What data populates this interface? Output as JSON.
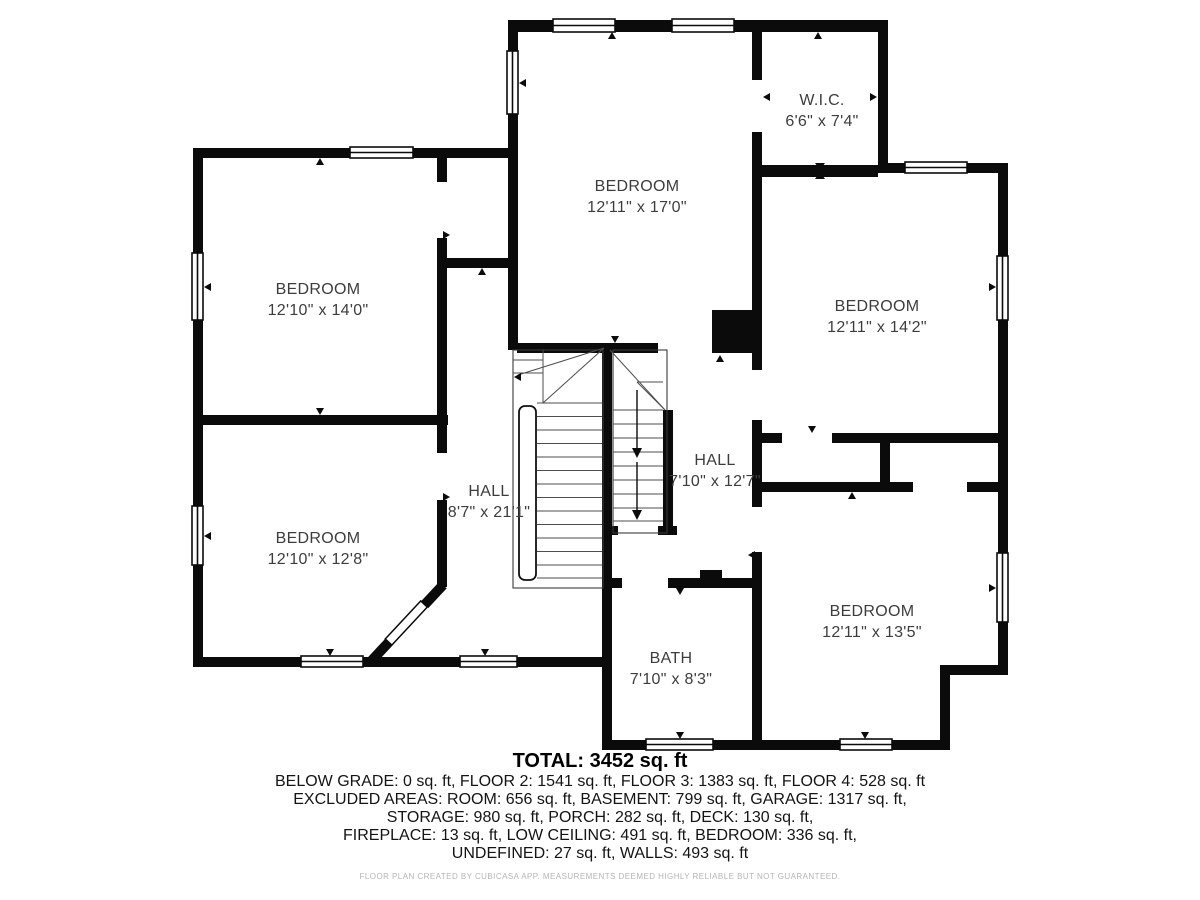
{
  "plan": {
    "rooms": [
      {
        "name": "BEDROOM",
        "dims": "12'10\" x 14'0\""
      },
      {
        "name": "BEDROOM",
        "dims": "12'10\" x 12'8\""
      },
      {
        "name": "BEDROOM",
        "dims": "12'11\" x 17'0\""
      },
      {
        "name": "W.I.C.",
        "dims": "6'6\" x 7'4\""
      },
      {
        "name": "BEDROOM",
        "dims": "12'11\" x 14'2\""
      },
      {
        "name": "HALL",
        "dims": "8'7\" x 21'1\""
      },
      {
        "name": "HALL",
        "dims": "7'10\" x 12'7\""
      },
      {
        "name": "BATH",
        "dims": "7'10\" x 8'3\""
      },
      {
        "name": "BEDROOM",
        "dims": "12'11\" x 13'5\""
      }
    ],
    "summary": {
      "total": "TOTAL: 3452 sq. ft",
      "lines": [
        "BELOW GRADE: 0 sq. ft, FLOOR 2: 1541 sq. ft, FLOOR 3: 1383 sq. ft, FLOOR 4: 528 sq. ft",
        "EXCLUDED AREAS: ROOM: 656 sq. ft, BASEMENT: 799 sq. ft, GARAGE: 1317 sq. ft,",
        "STORAGE: 980 sq. ft, PORCH: 282 sq. ft, DECK: 130 sq. ft,",
        "FIREPLACE: 13 sq. ft, LOW CEILING: 491 sq. ft, BEDROOM: 336 sq. ft,",
        "UNDEFINED: 27 sq. ft, WALLS: 493 sq. ft"
      ]
    },
    "footer": "FLOOR PLAN CREATED BY CUBICASA APP. MEASUREMENTS DEEMED HIGHLY RELIABLE BUT NOT GUARANTEED.",
    "colors": {
      "wall": "#0b0b0b",
      "label": "#3d3d3d",
      "footer": "#b5b5b5"
    }
  }
}
